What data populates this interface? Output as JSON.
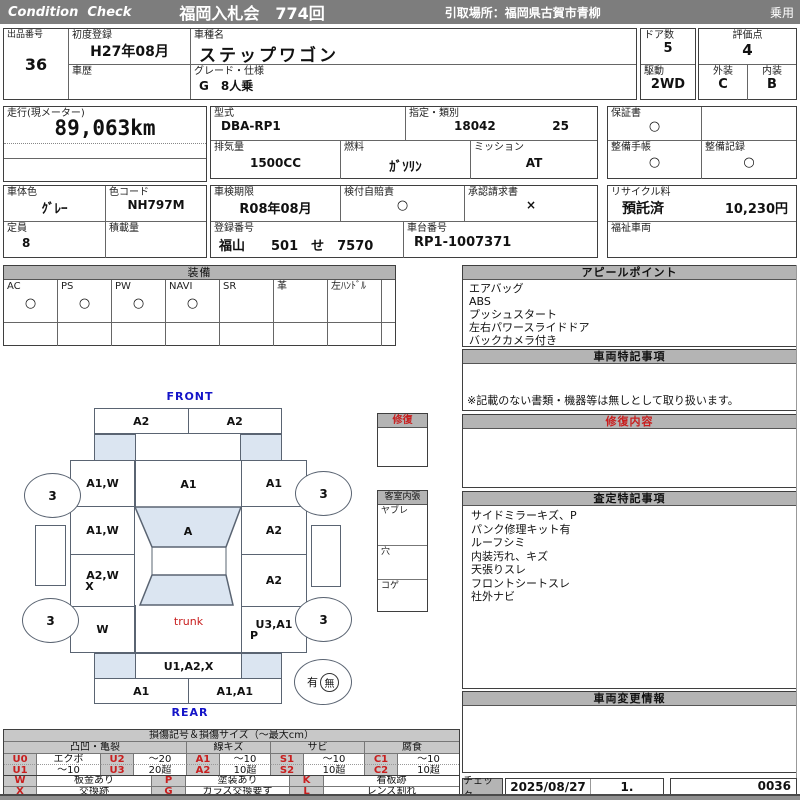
{
  "header": {
    "brand": "Condition  Check",
    "auction": "福岡入札会　774回",
    "pickup": "引取場所：福岡県古賀市青柳",
    "category": "乗用"
  },
  "info": {
    "lot_label": "出品番号",
    "lot_value": "36",
    "first_reg_label": "初度登録",
    "first_reg_value": "H27年08月",
    "history_label": "車歴",
    "model_label": "車種名",
    "model_value": "ステップワゴン",
    "grade_label": "グレード・仕様",
    "grade_value": "G　8人乗",
    "doors_label": "ドア数",
    "doors_value": "5",
    "drive_label": "駆動",
    "drive_value": "2WD",
    "score_label": "評価点",
    "score_value": "4",
    "exterior_label": "外装",
    "exterior_value": "C",
    "interior_label": "内装",
    "interior_value": "B",
    "odometer_label": "走行(現メーター)",
    "odometer_value": "89,063km",
    "model_code_label": "型式",
    "model_code_value": "DBA-RP1",
    "class_label": "指定・類別",
    "class_value1": "18042",
    "class_value2": "25",
    "warranty_label": "保証書",
    "warranty_value": "○",
    "displacement_label": "排気量",
    "displacement_value": "1500CC",
    "fuel_label": "燃料",
    "fuel_value": "ｶﾞｿﾘﾝ",
    "transmission_label": "ミッション",
    "transmission_value": "AT",
    "maintenance_book_label": "整備手帳",
    "maintenance_book_value": "○",
    "maintenance_record_label": "整備記録",
    "maintenance_record_value": "○",
    "body_color_label": "車体色",
    "body_color_value": "ｸﾞﾚｰ",
    "color_code_label": "色コード",
    "color_code_value": "NH797M",
    "inspection_label": "車検期限",
    "inspection_value": "R08年08月",
    "insurance_label": "検付自賠責",
    "insurance_value": "○",
    "approval_label": "承認請求書",
    "approval_value": "×",
    "recycle_label": "リサイクル料",
    "recycle_status": "預託済",
    "recycle_fee": "10,230円",
    "capacity_label": "定員",
    "capacity_value": "8",
    "load_label": "積載量",
    "registration_label": "登録番号",
    "registration_value": "福山　　501　せ　7570",
    "chassis_label": "車台番号",
    "chassis_value": "RP1-1007371",
    "welfare_label": "福祉車両"
  },
  "equipment": {
    "title": "装備",
    "items": [
      {
        "label": "AC",
        "value": "○"
      },
      {
        "label": "PS",
        "value": "○"
      },
      {
        "label": "PW",
        "value": "○"
      },
      {
        "label": "NAVI",
        "value": "○"
      },
      {
        "label": "SR",
        "value": ""
      },
      {
        "label": "革",
        "value": ""
      },
      {
        "label": "左ﾊﾝﾄﾞﾙ",
        "value": ""
      }
    ]
  },
  "appeal": {
    "title": "アピールポイント",
    "items": [
      "エアバッグ",
      "ABS",
      "プッシュスタート",
      "左右パワースライドドア",
      "バックカメラ付き"
    ]
  },
  "special_notes": {
    "title": "車両特記事項",
    "footnote": "※記載のない書類・機器等は無しとして取り扱います。"
  },
  "repair_content": {
    "title": "修復内容"
  },
  "assessment": {
    "title": "査定特記事項",
    "items": [
      "サイドミラーキズ、P",
      "パンク修理キット有",
      "ルーフシミ",
      "内装汚れ、キズ",
      "天張りスレ",
      "フロントシートスレ",
      "社外ナビ"
    ]
  },
  "change_info": {
    "title": "車両変更情報"
  },
  "check": {
    "label": "チェック",
    "date": "2025/08/27",
    "count": "1.",
    "sheet_no": "0036"
  },
  "diagram": {
    "front_label": "FRONT",
    "rear_label": "REAR",
    "trunk_label": "trunk",
    "front_bumper": [
      "A2",
      "A2"
    ],
    "left_panels": [
      "A1,W",
      "A1,W",
      "A2,W",
      "W"
    ],
    "left_panel3_line2": "X",
    "right_panels": [
      "A1",
      "A2",
      "A2",
      "U3,A1"
    ],
    "right_panel4_line2": "P",
    "hood": "A1",
    "windshield": "A",
    "rear_gate": "U1,A2,X",
    "rear_bumper": [
      "A1",
      "A1,A1"
    ],
    "tire_rating": "3",
    "repair_box_title": "修復",
    "cabin_box_title": "客室内張",
    "cabin_rows": [
      "ヤブレ",
      "穴",
      "コゲ"
    ],
    "history_yes": "有",
    "history_no": "無"
  },
  "legend": {
    "title": "損傷記号＆損傷サイズ（～最大cm）",
    "groups": [
      "凸凹・亀裂",
      "線キズ",
      "サビ",
      "腐食"
    ],
    "row1": [
      "U0",
      "エクボ",
      "U2",
      "～20",
      "A1",
      "～10",
      "S1",
      "～10",
      "C1",
      "～10"
    ],
    "row2": [
      "U1",
      "～10",
      "U3",
      "20超",
      "A2",
      "10超",
      "S2",
      "10超",
      "C2",
      "10超"
    ],
    "row3": [
      "W",
      "板金あり",
      "P",
      "塗装あり",
      "K",
      "看板跡"
    ],
    "row4": [
      "X",
      "交換跡",
      "G",
      "ガラス交換要す",
      "L",
      "レンズ割れ"
    ]
  }
}
